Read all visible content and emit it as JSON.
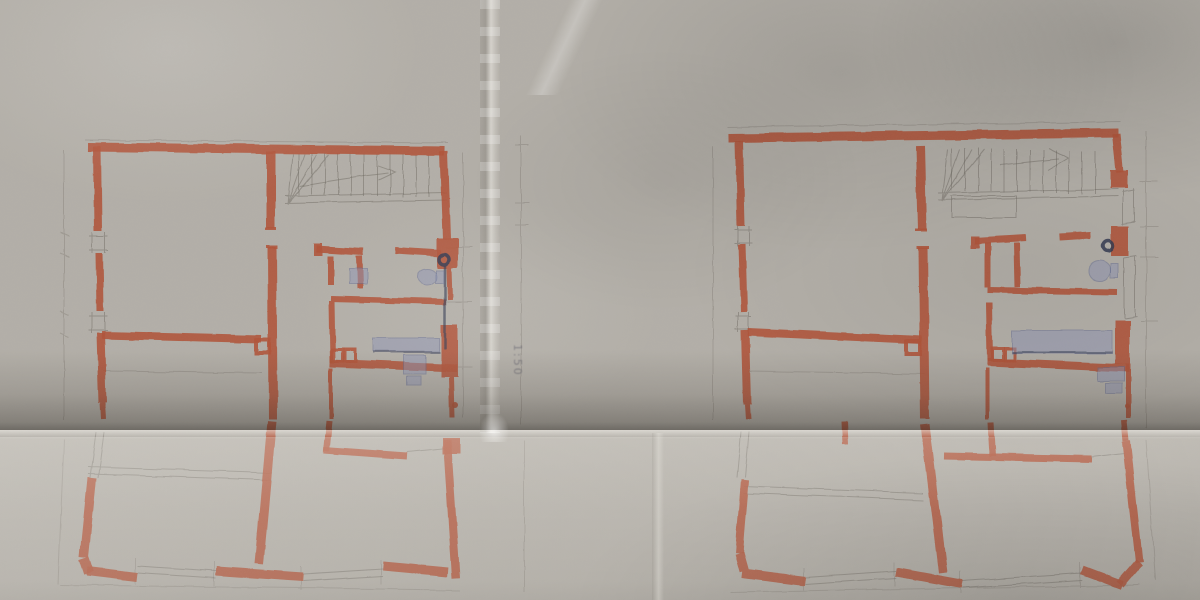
{
  "annotations": {
    "scale_note": "1:50"
  },
  "sheet": {
    "left_plan": "floor-plan-left",
    "right_plan": "floor-plan-right"
  },
  "colors": {
    "paper": "#b3afa8",
    "paper_below_fold": "#c4c1ba",
    "fold_shadow": "#544e45",
    "wall": "#b0543a",
    "wall_light": "#cd8164",
    "pencil": "#6f6b64",
    "blue_pen": "#646c94",
    "blue_fill": "#8d94b4",
    "ink": "#343a52"
  }
}
